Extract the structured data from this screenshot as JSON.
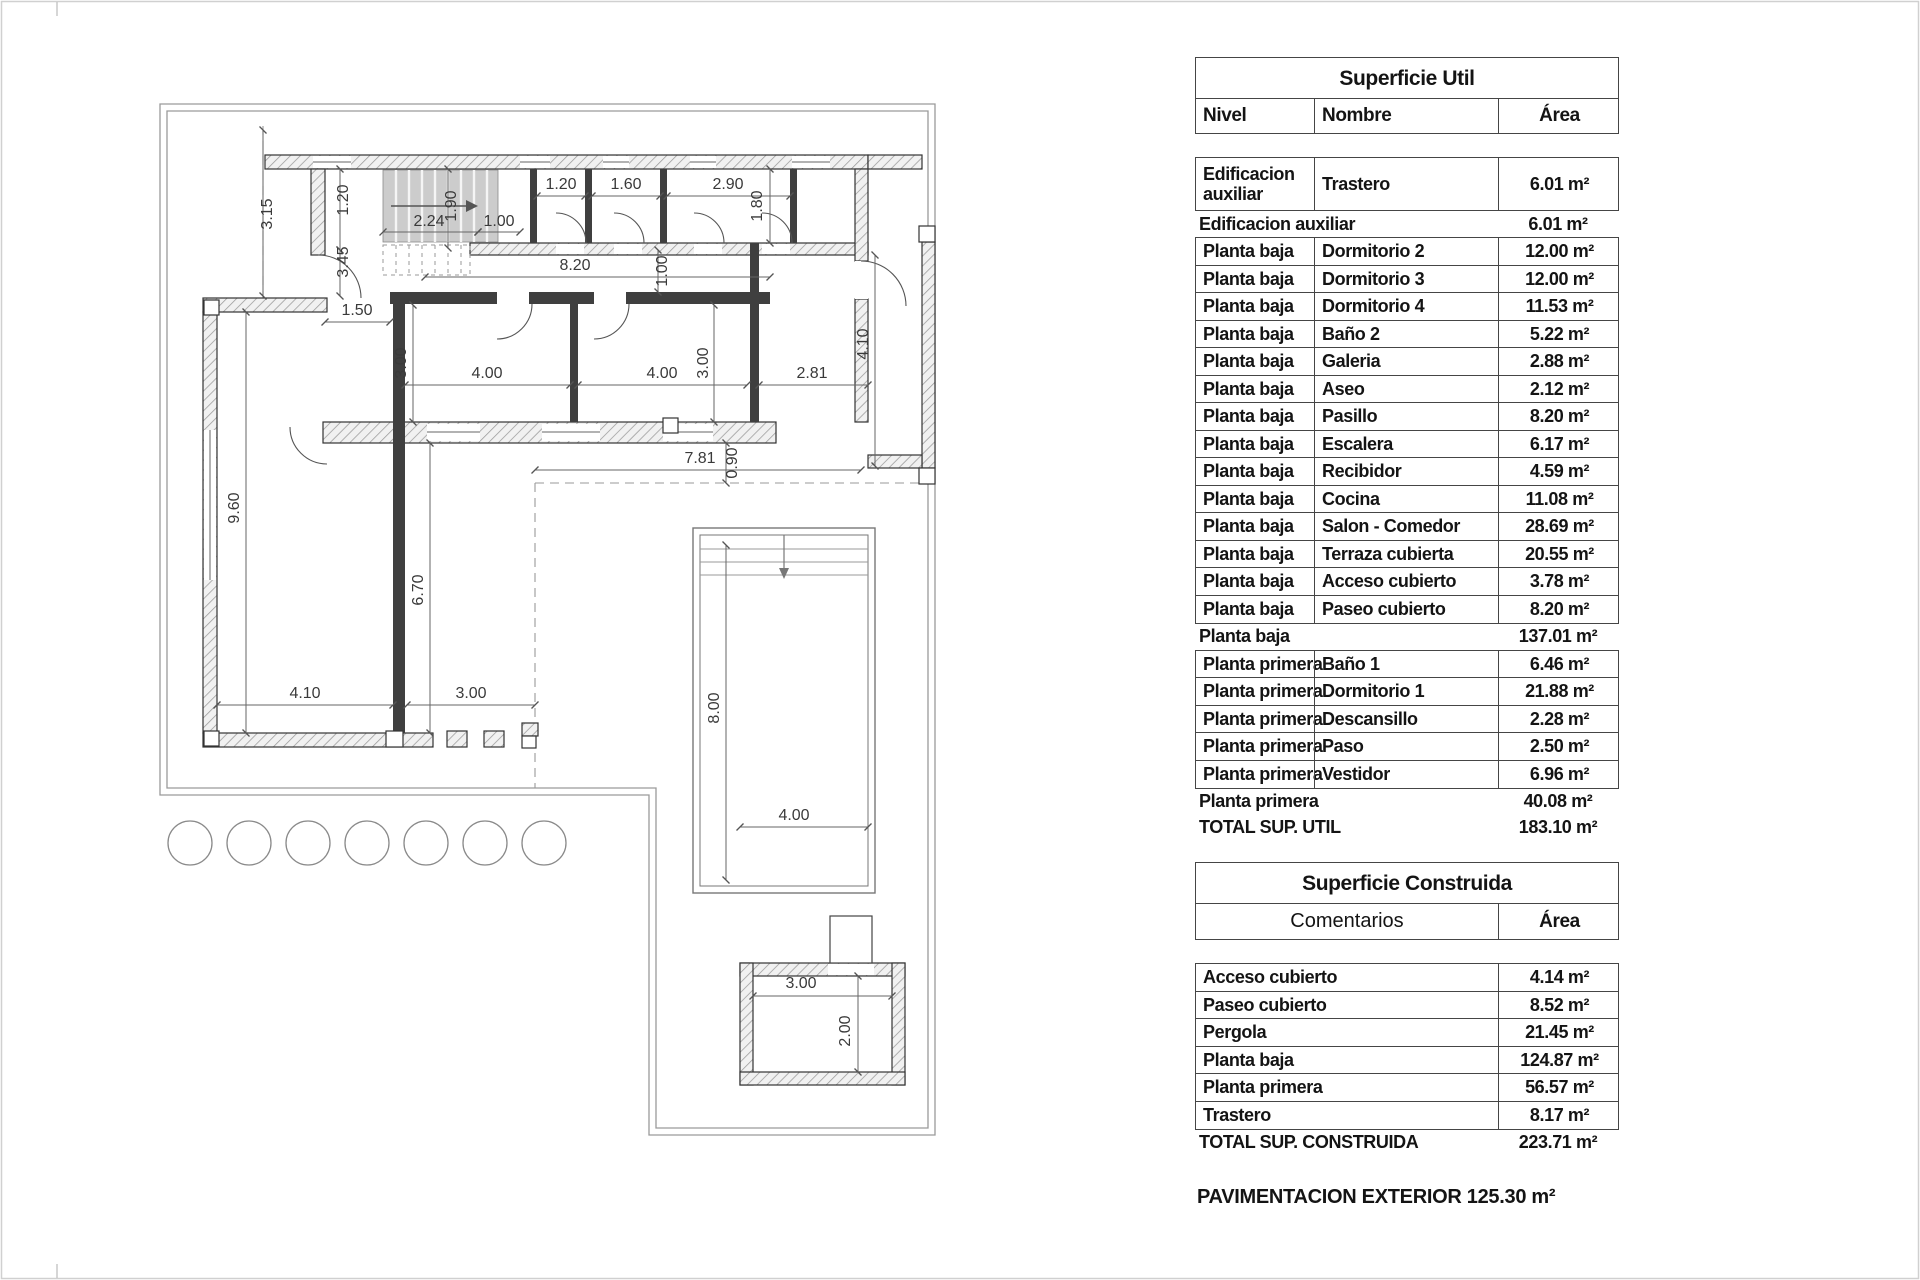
{
  "plan": {
    "dims": [
      {
        "t": "3.15",
        "x": 272,
        "y": 214,
        "r": -90
      },
      {
        "t": "1.20",
        "x": 348,
        "y": 200,
        "r": -90
      },
      {
        "t": "3.45",
        "x": 348,
        "y": 262,
        "r": -90
      },
      {
        "t": "1.90",
        "x": 456,
        "y": 206,
        "r": -90
      },
      {
        "t": "2.24",
        "x": 429,
        "y": 226,
        "r": 0
      },
      {
        "t": "1.00",
        "x": 499,
        "y": 226,
        "r": 0
      },
      {
        "t": "1.20",
        "x": 561,
        "y": 189,
        "r": 0
      },
      {
        "t": "1.60",
        "x": 626,
        "y": 189,
        "r": 0
      },
      {
        "t": "2.90",
        "x": 728,
        "y": 189,
        "r": 0
      },
      {
        "t": "1.80",
        "x": 762,
        "y": 206,
        "r": -90
      },
      {
        "t": "8.20",
        "x": 575,
        "y": 270,
        "r": 0
      },
      {
        "t": "1.00",
        "x": 667,
        "y": 271,
        "r": -90
      },
      {
        "t": "1.50",
        "x": 357,
        "y": 315,
        "r": 0
      },
      {
        "t": "3.00",
        "x": 406,
        "y": 363,
        "r": -90
      },
      {
        "t": "4.00",
        "x": 487,
        "y": 378,
        "r": 0
      },
      {
        "t": "4.00",
        "x": 662,
        "y": 378,
        "r": 0
      },
      {
        "t": "3.00",
        "x": 708,
        "y": 363,
        "r": -90
      },
      {
        "t": "2.81",
        "x": 812,
        "y": 378,
        "r": 0
      },
      {
        "t": "4.10",
        "x": 868,
        "y": 344,
        "r": -90
      },
      {
        "t": "7.81",
        "x": 700,
        "y": 463,
        "r": 0
      },
      {
        "t": "0.90",
        "x": 737,
        "y": 463,
        "r": -90
      },
      {
        "t": "9.60",
        "x": 239,
        "y": 508,
        "r": -90
      },
      {
        "t": "6.70",
        "x": 423,
        "y": 590,
        "r": -90
      },
      {
        "t": "4.10",
        "x": 305,
        "y": 698,
        "r": 0
      },
      {
        "t": "3.00",
        "x": 471,
        "y": 698,
        "r": 0
      },
      {
        "t": "8.00",
        "x": 719,
        "y": 708,
        "r": -90
      },
      {
        "t": "4.00",
        "x": 794,
        "y": 820,
        "r": 0
      },
      {
        "t": "3.00",
        "x": 801,
        "y": 988,
        "r": 0
      },
      {
        "t": "2.00",
        "x": 850,
        "y": 1031,
        "r": -90
      }
    ]
  },
  "superficie_util": {
    "title": "Superficie Util",
    "col_nivel": "Nivel",
    "col_nombre": "Nombre",
    "col_area": "Área",
    "rows": [
      {
        "type": "data",
        "nivel": "Edificacion auxiliar",
        "nombre": "Trastero",
        "area": "6.01 m²",
        "tall": true
      },
      {
        "type": "subtotal",
        "label": "Edificacion auxiliar",
        "area": "6.01 m²"
      },
      {
        "type": "data",
        "nivel": "Planta baja",
        "nombre": "Dormitorio 2",
        "area": "12.00 m²"
      },
      {
        "type": "data",
        "nivel": "Planta baja",
        "nombre": "Dormitorio 3",
        "area": "12.00 m²"
      },
      {
        "type": "data",
        "nivel": "Planta baja",
        "nombre": "Dormitorio 4",
        "area": "11.53 m²"
      },
      {
        "type": "data",
        "nivel": "Planta baja",
        "nombre": "Baño 2",
        "area": "5.22 m²"
      },
      {
        "type": "data",
        "nivel": "Planta baja",
        "nombre": "Galeria",
        "area": "2.88 m²"
      },
      {
        "type": "data",
        "nivel": "Planta baja",
        "nombre": "Aseo",
        "area": "2.12 m²"
      },
      {
        "type": "data",
        "nivel": "Planta baja",
        "nombre": "Pasillo",
        "area": "8.20 m²"
      },
      {
        "type": "data",
        "nivel": "Planta baja",
        "nombre": "Escalera",
        "area": "6.17 m²"
      },
      {
        "type": "data",
        "nivel": "Planta baja",
        "nombre": "Recibidor",
        "area": "4.59 m²"
      },
      {
        "type": "data",
        "nivel": "Planta baja",
        "nombre": "Cocina",
        "area": "11.08 m²"
      },
      {
        "type": "data",
        "nivel": "Planta baja",
        "nombre": "Salon - Comedor",
        "area": "28.69 m²"
      },
      {
        "type": "data",
        "nivel": "Planta baja",
        "nombre": "Terraza cubierta",
        "area": "20.55 m²"
      },
      {
        "type": "data",
        "nivel": "Planta baja",
        "nombre": "Acceso cubierto",
        "area": "3.78 m²"
      },
      {
        "type": "data",
        "nivel": "Planta baja",
        "nombre": "Paseo cubierto",
        "area": "8.20 m²"
      },
      {
        "type": "subtotal",
        "label": "Planta baja",
        "area": "137.01 m²"
      },
      {
        "type": "data",
        "nivel": "Planta primera",
        "nombre": "Baño 1",
        "area": "6.46 m²"
      },
      {
        "type": "data",
        "nivel": "Planta primera",
        "nombre": "Dormitorio 1",
        "area": "21.88 m²"
      },
      {
        "type": "data",
        "nivel": "Planta primera",
        "nombre": "Descansillo",
        "area": "2.28 m²"
      },
      {
        "type": "data",
        "nivel": "Planta primera",
        "nombre": "Paso",
        "area": "2.50 m²"
      },
      {
        "type": "data",
        "nivel": "Planta primera",
        "nombre": "Vestidor",
        "area": "6.96 m²"
      },
      {
        "type": "subtotal",
        "label": "Planta primera",
        "area": "40.08 m²"
      },
      {
        "type": "subtotal",
        "label": "TOTAL SUP. UTIL",
        "area": "183.10 m²"
      }
    ]
  },
  "superficie_construida": {
    "title": "Superficie Construida",
    "col_comentarios": "Comentarios",
    "col_area": "Área",
    "rows": [
      {
        "type": "data",
        "label": "Acceso cubierto",
        "area": "4.14 m²"
      },
      {
        "type": "data",
        "label": "Paseo cubierto",
        "area": "8.52 m²"
      },
      {
        "type": "data",
        "label": "Pergola",
        "area": "21.45 m²"
      },
      {
        "type": "data",
        "label": "Planta baja",
        "area": "124.87 m²"
      },
      {
        "type": "data",
        "label": "Planta primera",
        "area": "56.57 m²"
      },
      {
        "type": "data",
        "label": "Trastero",
        "area": "8.17 m²"
      },
      {
        "type": "subtotal",
        "label": "TOTAL SUP. CONSTRUIDA",
        "area": "223.71 m²"
      }
    ]
  },
  "footer": {
    "pavimentacion": "PAVIMENTACION EXTERIOR 125.30 m²"
  }
}
